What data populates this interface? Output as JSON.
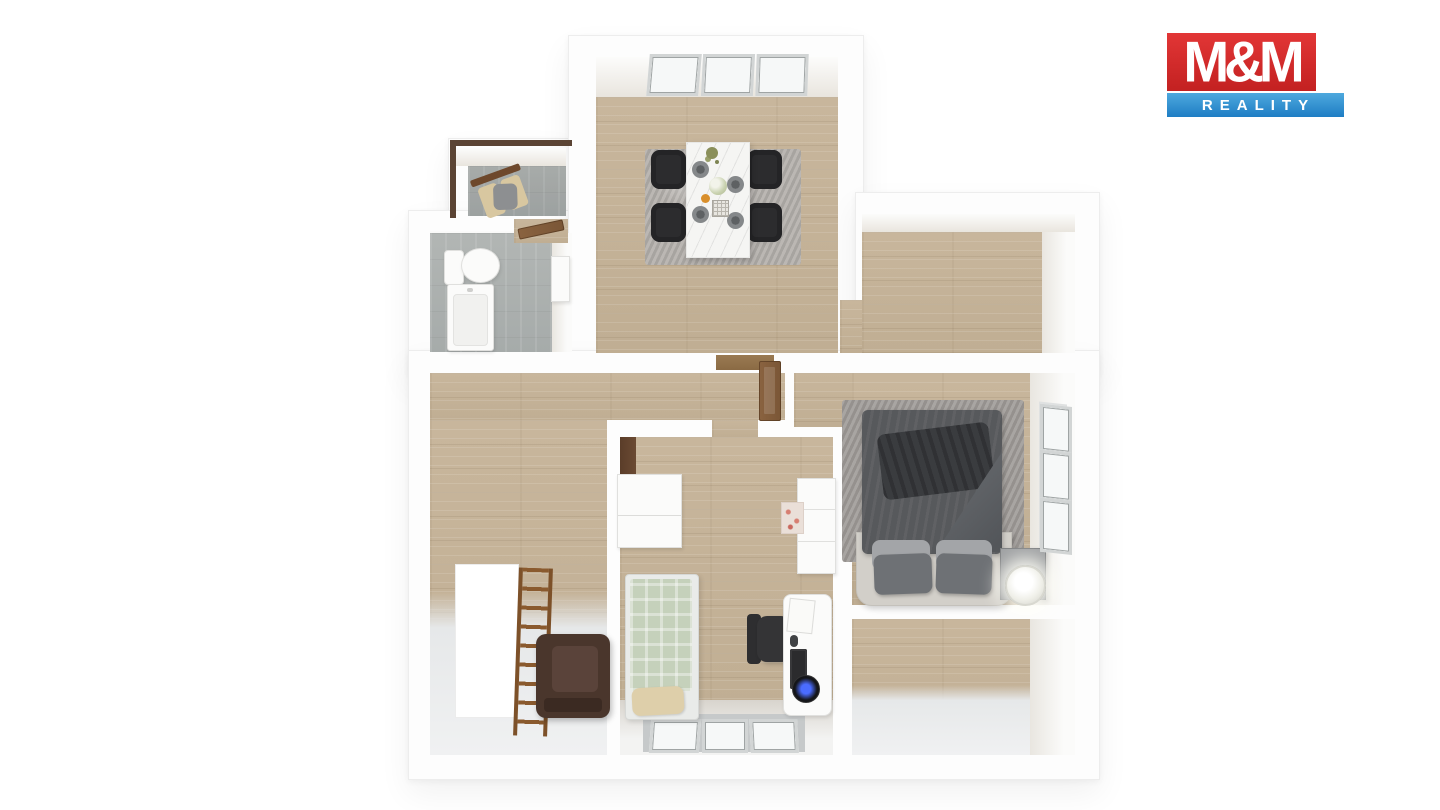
{
  "logo": {
    "top_text": "M&M",
    "bottom_text": "REALITY"
  },
  "colors": {
    "logo_red": "#d32b2b",
    "logo_blue": "#2f8fcd",
    "wall": "#fdfdfd",
    "wood": "#c8b69c",
    "tile": "#b2b6b4",
    "hall_floor": "#eceeef",
    "rug": "#a09c99",
    "duvet": "#57595c",
    "kid_bed_green": "#c5d1bb",
    "leather": "#4a362c",
    "door": "#7a5636",
    "marble": "#f5f5f3"
  },
  "floorplan": {
    "type": "3d-top-down-apartment-render",
    "rooms": [
      {
        "id": "entry-hall",
        "floor": "tile",
        "furniture": [
          "wooden-bench-chair"
        ],
        "windows": 0
      },
      {
        "id": "bathroom",
        "floor": "tile",
        "furniture": [
          "toilet",
          "bathtub",
          "wall-shelf"
        ],
        "windows": 0
      },
      {
        "id": "dining-room",
        "floor": "wood",
        "furniture": [
          "marble-dining-table",
          "four-dark-chairs",
          "gray-rug"
        ],
        "windows": 3
      },
      {
        "id": "room-top-right",
        "floor": "wood",
        "furniture": [],
        "windows": 0
      },
      {
        "id": "hallway",
        "floor": "wood-and-light",
        "furniture": [
          "wall-ladder",
          "leather-armchair",
          "stair-opening"
        ],
        "windows": 0
      },
      {
        "id": "kids-room",
        "floor": "wood",
        "furniture": [
          "single-bed-green",
          "white-dresser",
          "desk-with-pc",
          "office-chair",
          "white-wardrobe"
        ],
        "windows": 3
      },
      {
        "id": "bedroom",
        "floor": "wood",
        "furniture": [
          "double-bed-gray",
          "shag-rug",
          "nightstand",
          "glowing-lamp"
        ],
        "windows": 3
      },
      {
        "id": "room-bottom-right",
        "floor": "wood",
        "furniture": [],
        "windows": 0
      }
    ]
  }
}
